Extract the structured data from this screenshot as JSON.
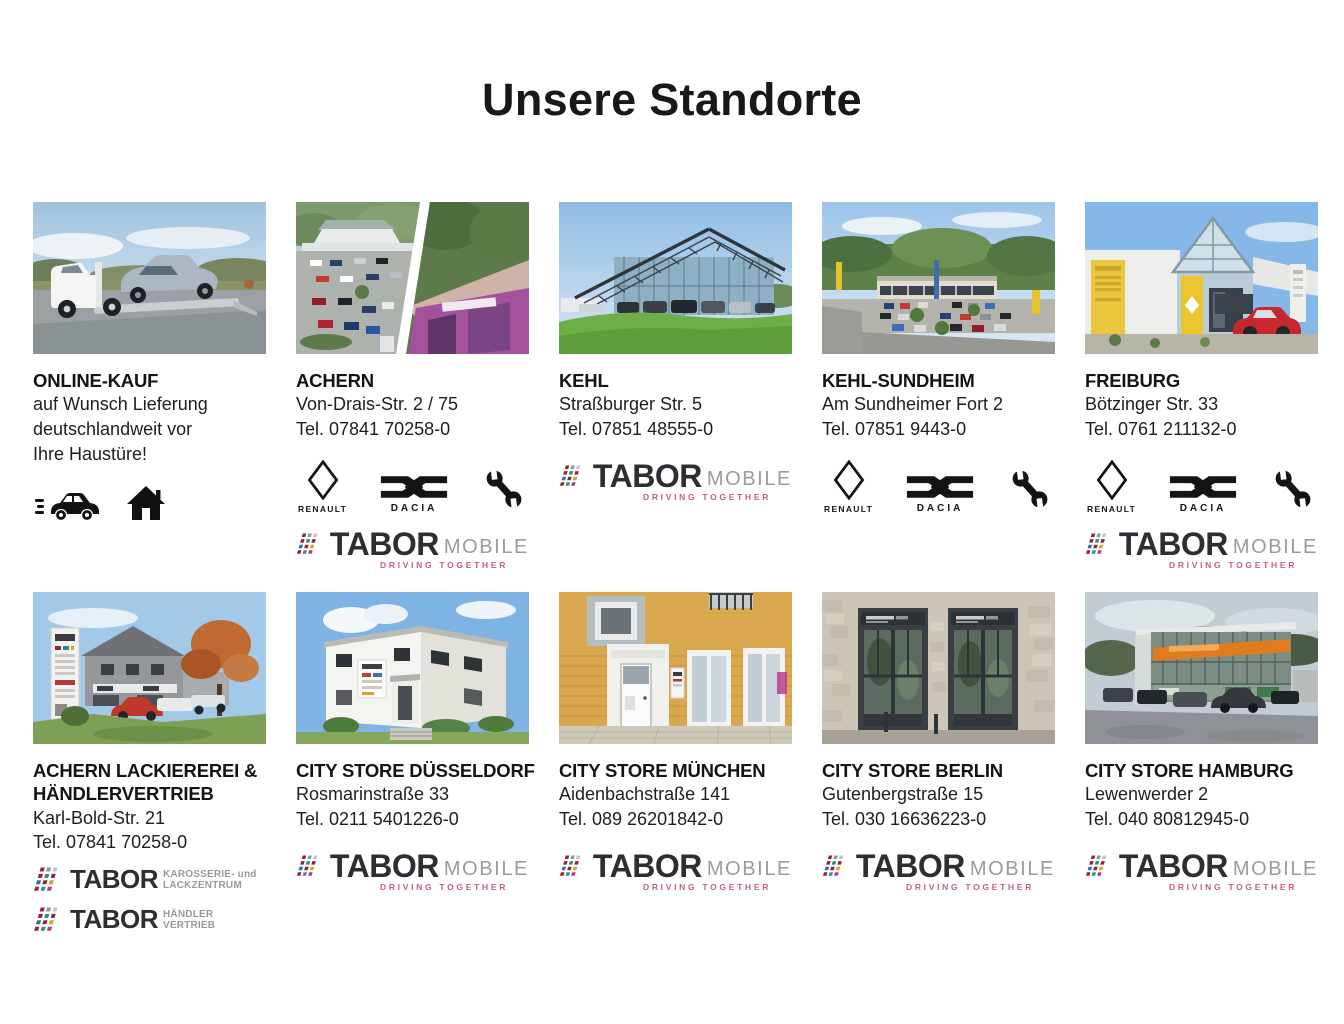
{
  "page": {
    "title": "Unsere Standorte"
  },
  "colors": {
    "tabor_dark": "#2d2d35",
    "tabor_gray": "#9b9b9b",
    "tabor_pink": "#c2607e",
    "brand_black": "#141414",
    "text": "#1c1c1c"
  },
  "logos": {
    "renault_label": "RENAULT",
    "dacia_label": "DACIA",
    "tabor": {
      "brand": "TABOR",
      "mobile": "MOBILE",
      "tagline": "DRIVING TOGETHER",
      "karosserie_line1": "KAROSSERIE- und",
      "karosserie_line2": "LACKZENTRUM",
      "haendler_line1": "HÄNDLER",
      "haendler_line2": "VERTRIEB"
    }
  },
  "locations": [
    {
      "name": "ONLINE-KAUF",
      "description": "auf Wunsch Lieferung\ndeutschlandweit vor\nIhre Haustüre!"
    },
    {
      "name": "ACHERN",
      "address": "Von-Drais-Str. 2 / 75",
      "phone": "Tel. 07841 70258-0"
    },
    {
      "name": "KEHL",
      "address": "Straßburger Str. 5",
      "phone": "Tel. 07851 48555-0"
    },
    {
      "name": "KEHL-SUNDHEIM",
      "address": "Am Sundheimer Fort 2",
      "phone": "Tel. 07851 9443-0"
    },
    {
      "name": "FREIBURG",
      "address": "Bötzinger Str. 33",
      "phone": "Tel. 0761 211132-0"
    },
    {
      "name": "ACHERN LACKIEREREI & HÄNDLERVERTRIEB",
      "address": "Karl-Bold-Str. 21",
      "phone": "Tel. 07841 70258-0"
    },
    {
      "name": "CITY STORE DÜSSELDORF",
      "address": "Rosmarinstraße 33",
      "phone": "Tel. 0211 5401226-0"
    },
    {
      "name": "CITY STORE MÜNCHEN",
      "address": "Aidenbachstraße 141",
      "phone": "Tel. 089 26201842-0"
    },
    {
      "name": "CITY STORE BERLIN",
      "address": "Gutenbergstraße 15",
      "phone": "Tel. 030 16636223-0"
    },
    {
      "name": "CITY STORE HAMBURG",
      "address": "Lewenwerder 2",
      "phone": "Tel. 040 80812945-0"
    }
  ]
}
